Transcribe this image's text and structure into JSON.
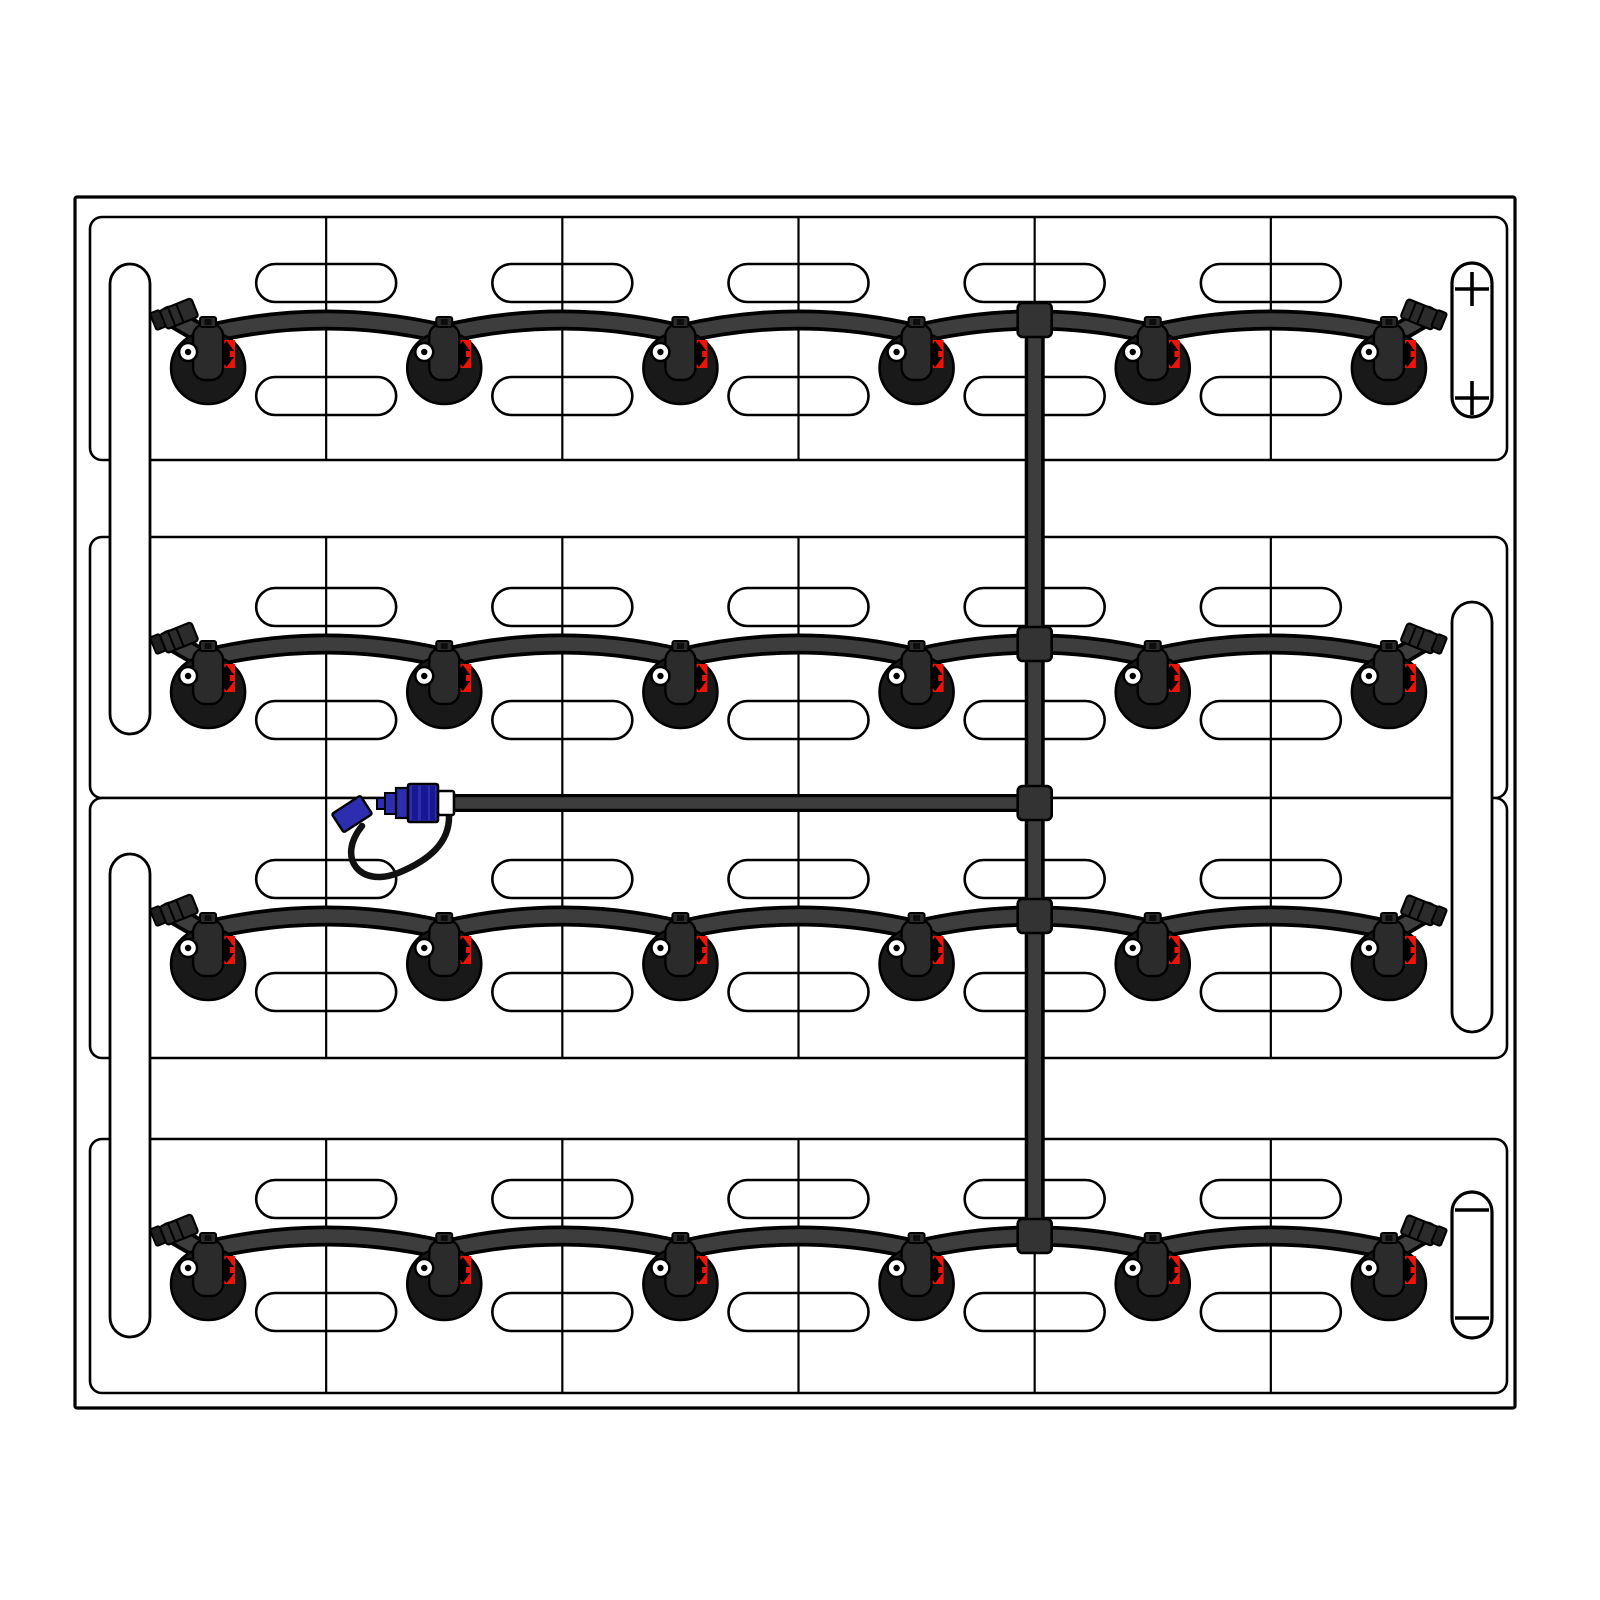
{
  "diagram": {
    "title": "Battery watering system kit - top view of battery",
    "type": "technical-diagram",
    "rows_count": 4,
    "cells_per_row": 6,
    "valves_total": 24,
    "vent_pills_per_row": 10,
    "terminals": {
      "positive": {
        "symbol": "+",
        "position": "top-right",
        "marks": 2
      },
      "negative": {
        "symbol": "−",
        "position": "bottom-right",
        "marks": 2
      }
    },
    "components": {
      "battery_case": "battery case outline",
      "cell_tray": "cell row tray",
      "cell_divider": "cell divider line",
      "vent_pill": "cell vent / handle slot",
      "lift_handle": "lifting strap slot",
      "watering_valve": "automatic watering valve with level eye and red flow indicator",
      "row_tube": "row watering tube",
      "manifold_tube": "vertical manifold tube",
      "supply_tube": "water supply tube",
      "junction_fitting": "tee / cross fitting",
      "coupler": "quick-connect water coupler with dust cap and lanyard"
    },
    "colors": {
      "background": "#ffffff",
      "outline": "#000000",
      "tube_gray": "#3d3d3d",
      "fitting_gray": "#333333",
      "valve_body": "#191919",
      "valve_cap": "#2b2b2b",
      "indicator_red": "#ec1309",
      "coupler_blue": "#2d2db0",
      "coupler_blue_dark": "#171794",
      "collar_white": "#ffffff"
    },
    "geometry": {
      "canvas": {
        "w": 1600,
        "h": 1600
      },
      "case": {
        "x": 75,
        "y": 197,
        "w": 1440,
        "h": 1211
      },
      "tray_x": 90,
      "tray_right": 1507,
      "rows": [
        {
          "tray_top": 217,
          "tray_bottom": 460,
          "peak": 320
        },
        {
          "tray_top": 537,
          "tray_bottom": 798,
          "peak": 644
        },
        {
          "tray_top": 798,
          "tray_bottom": 1058,
          "peak": 916
        },
        {
          "tray_top": 1139,
          "tray_bottom": 1393,
          "peak": 1236
        }
      ],
      "pill": {
        "w": 140,
        "h": 38,
        "top_dy": -37,
        "bottom_dy": 76
      },
      "handles": [
        {
          "x": 110,
          "y": 264,
          "w": 40,
          "h": 470
        },
        {
          "x": 110,
          "y": 854,
          "w": 40,
          "h": 483
        },
        {
          "x": 1452,
          "y": 602,
          "w": 40,
          "h": 430
        }
      ],
      "positive_pill": {
        "x": 1452,
        "y": 263,
        "w": 40,
        "h": 154,
        "mark_cy": [
          289,
          398
        ]
      },
      "negative_pill": {
        "x": 1452,
        "y": 1192,
        "w": 40,
        "h": 146,
        "mark_cy": [
          1210,
          1318
        ]
      },
      "manifold": {
        "x": 1034.7,
        "top": 320,
        "bottom": 1236,
        "junction_y": [
          320,
          644,
          803,
          916,
          1236
        ]
      },
      "supply": {
        "y": 803,
        "x_start": 450,
        "x_end": 1034.7
      },
      "coupler": {
        "x": 340,
        "y": 783
      }
    }
  }
}
